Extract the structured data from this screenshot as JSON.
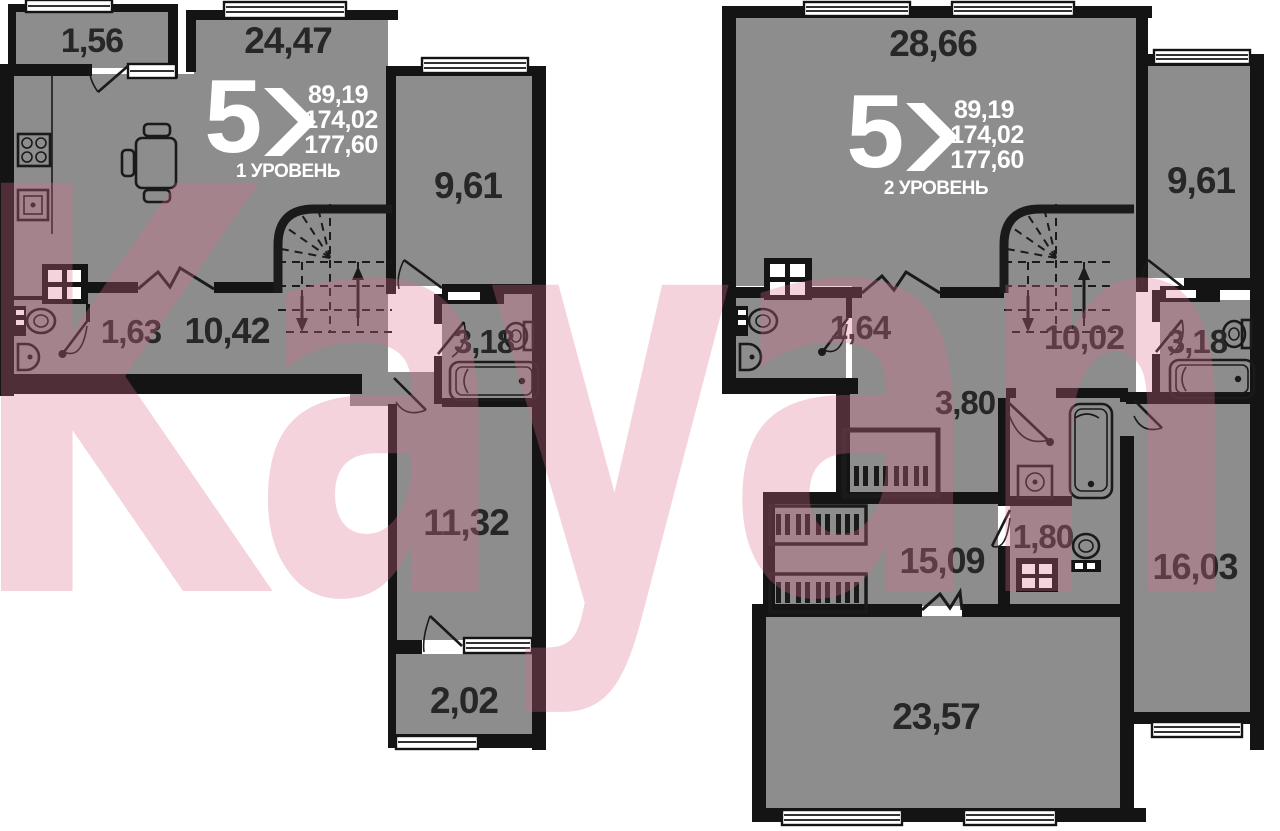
{
  "watermark": {
    "text": "Kayan",
    "color": "#db6c8a"
  },
  "colors": {
    "wall": "#141414",
    "room_fill": "#8d8d8d",
    "label": "#272727",
    "logo_text": "#ffffff",
    "background": "#ffffff"
  },
  "plan1": {
    "level_label": "1 УРОВЕНЬ",
    "logo_number": "5",
    "stats": [
      "89,19",
      "174,02",
      "177,60"
    ],
    "areas": {
      "balcony": "1,56",
      "living": "24,47",
      "bedroom": "9,61",
      "wc": "1,63",
      "hall": "10,42",
      "bath": "3,18",
      "room": "11,32",
      "loggia": "2,02"
    }
  },
  "plan2": {
    "level_label": "2 УРОВЕНЬ",
    "logo_number": "5",
    "stats": [
      "89,19",
      "174,02",
      "177,60"
    ],
    "areas": {
      "living": "28,66",
      "bedroom": "9,61",
      "wc": "1,64",
      "hall": "10,02",
      "bath": "3,18",
      "hall2": "3,80",
      "room": "15,09",
      "bath2": "1,80",
      "bedroom2": "16,03",
      "living2": "23,57"
    }
  },
  "icons": [
    "stove-icon",
    "oven-icon",
    "dining-table-icon",
    "toilet-icon",
    "sink-icon",
    "bathtub-icon",
    "washing-machine-icon",
    "vent-shaft-icon",
    "wardrobe-icon",
    "stairs-icon",
    "window-icon",
    "door-icon"
  ]
}
